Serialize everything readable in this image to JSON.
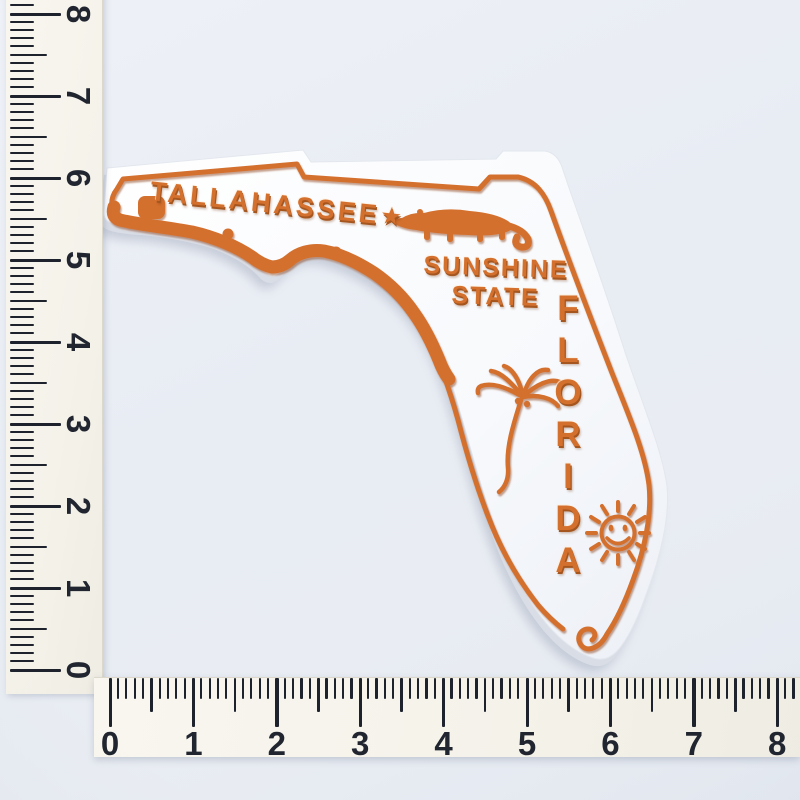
{
  "scene": {
    "background_color": "#e9edf3",
    "subject": "Florida state rubber fridge magnet with measuring rulers"
  },
  "magnet": {
    "capital_label": "TALLAHASSEE",
    "capital_star": "★",
    "nickname_line1": "SUNSHINE",
    "nickname_line2": "STATE",
    "state_name": "FLORIDA",
    "colors": {
      "artwork_orange": "#d4702e",
      "base_white": "#fbfcfe",
      "edge_grey": "#d9dde6",
      "cast_shadow": "#8e98ad"
    },
    "icons": {
      "alligator": "alligator-icon",
      "palm_tree": "palm-tree-icon",
      "sun": "smiling-sun-icon",
      "capital_star": "capital-star-icon",
      "south_tip_curl": "border-curl-icon"
    }
  },
  "rulers": {
    "vertical": {
      "labels": [
        "8",
        "7",
        "6",
        "5",
        "4",
        "3",
        "2",
        "1",
        "0"
      ]
    },
    "horizontal": {
      "labels": [
        "0",
        "1",
        "2",
        "3",
        "4",
        "5",
        "6",
        "7",
        "8"
      ]
    }
  }
}
